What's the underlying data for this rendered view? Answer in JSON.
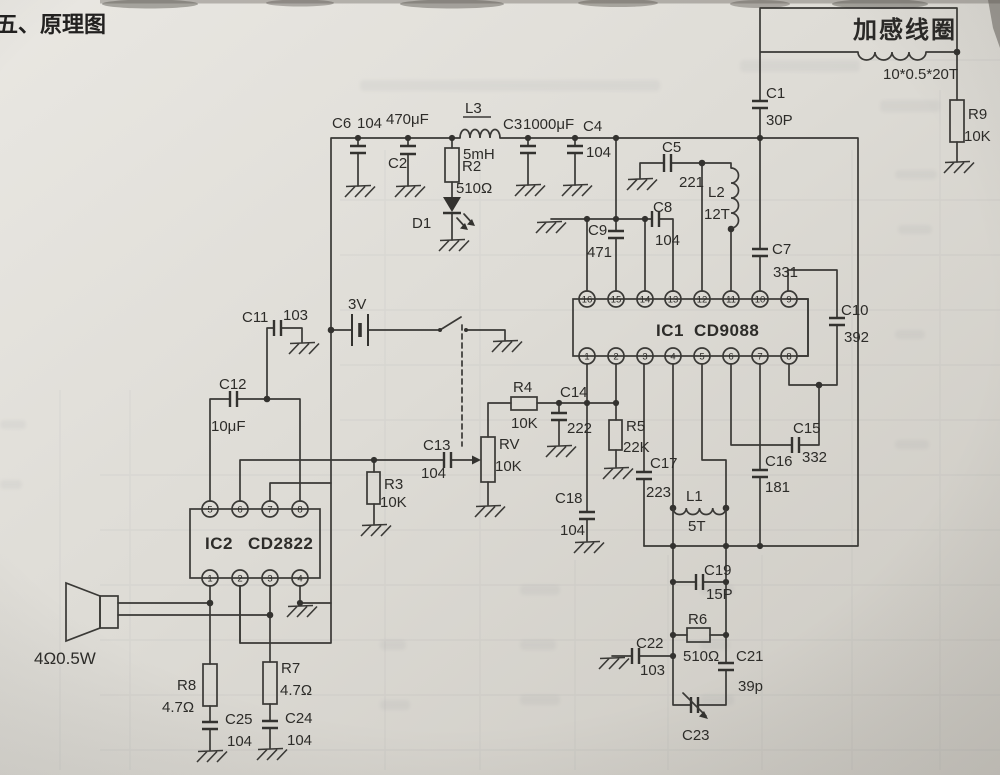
{
  "page": {
    "title": "五、原理图"
  },
  "antenna": {
    "coil_label": "加感线圈",
    "coil_spec": "10*0.5*20T"
  },
  "power": {
    "battery": "3V"
  },
  "speaker": {
    "spec": "4Ω0.5W"
  },
  "ic1": {
    "name": "IC1",
    "part": "CD9088",
    "pins_top": [
      "16",
      "15",
      "14",
      "13",
      "12",
      "11",
      "10",
      "9"
    ],
    "pins_bottom": [
      "1",
      "2",
      "3",
      "4",
      "5",
      "6",
      "7",
      "8"
    ]
  },
  "ic2": {
    "name": "IC2",
    "part": "CD2822",
    "pins_top": [
      "5",
      "6",
      "7",
      "8"
    ],
    "pins_bottom": [
      "1",
      "2",
      "3",
      "4"
    ]
  },
  "components": {
    "C1": {
      "ref": "C1",
      "value": "30P"
    },
    "C2": {
      "ref": "C2",
      "value": "470μF"
    },
    "C3": {
      "ref": "C3",
      "value": "1000μF"
    },
    "C4": {
      "ref": "C4",
      "value": "104"
    },
    "C5": {
      "ref": "C5",
      "value": "221"
    },
    "C6": {
      "ref": "C6",
      "value": "104"
    },
    "C7": {
      "ref": "C7",
      "value": "331"
    },
    "C8": {
      "ref": "C8",
      "value": "104"
    },
    "C9": {
      "ref": "C9",
      "value": "471"
    },
    "C10": {
      "ref": "C10",
      "value": "392"
    },
    "C11": {
      "ref": "C11",
      "value": "103"
    },
    "C12": {
      "ref": "C12",
      "value": "10μF"
    },
    "C13": {
      "ref": "C13",
      "value": "104"
    },
    "C14": {
      "ref": "C14",
      "value": "222"
    },
    "C15": {
      "ref": "C15",
      "value": "332"
    },
    "C16": {
      "ref": "C16",
      "value": "181"
    },
    "C17": {
      "ref": "C17",
      "value": "223"
    },
    "C18": {
      "ref": "C18",
      "value": "104"
    },
    "C19": {
      "ref": "C19",
      "value": "15P"
    },
    "C21": {
      "ref": "C21",
      "value": "39p"
    },
    "C22": {
      "ref": "C22",
      "value": "103"
    },
    "C23": {
      "ref": "C23",
      "value": ""
    },
    "C24": {
      "ref": "C24",
      "value": "104"
    },
    "C25": {
      "ref": "C25",
      "value": "104"
    },
    "R2": {
      "ref": "R2",
      "value": "510Ω"
    },
    "R3": {
      "ref": "R3",
      "value": "10K"
    },
    "R4": {
      "ref": "R4",
      "value": "10K"
    },
    "R5": {
      "ref": "R5",
      "value": "22K"
    },
    "R6": {
      "ref": "R6",
      "value": "510Ω"
    },
    "R7": {
      "ref": "R7",
      "value": "4.7Ω"
    },
    "R8": {
      "ref": "R8",
      "value": "4.7Ω"
    },
    "R9": {
      "ref": "R9",
      "value": "10K"
    },
    "RV": {
      "ref": "RV",
      "value": "10K"
    },
    "L1": {
      "ref": "L1",
      "value": "5T"
    },
    "L2": {
      "ref": "L2",
      "value": "12T"
    },
    "L3": {
      "ref": "L3",
      "value": "5mH"
    },
    "D1": {
      "ref": "D1",
      "value": ""
    }
  }
}
